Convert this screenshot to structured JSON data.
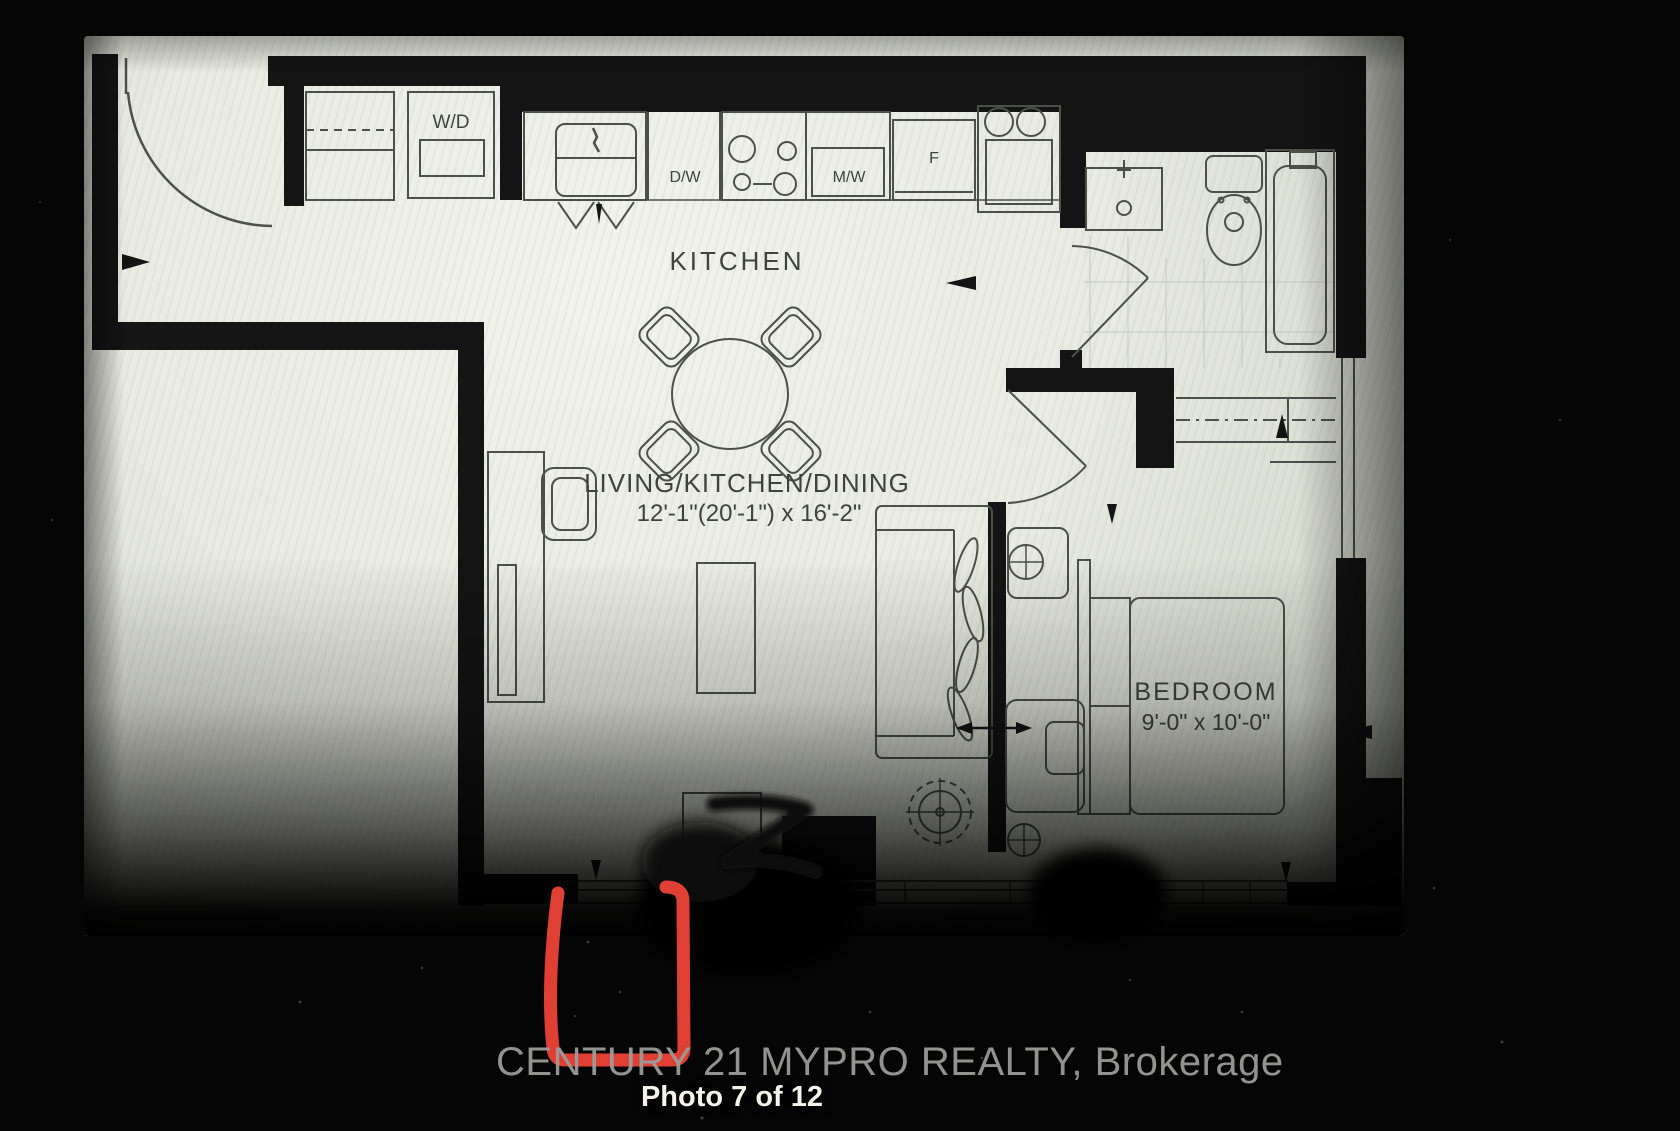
{
  "photo": {
    "watermark": "CENTURY 21 MYPRO REALTY, Brokerage",
    "caption": "Photo 7 of 12"
  },
  "floor_plan": {
    "rooms": [
      {
        "label": "KITCHEN",
        "dimensions": ""
      },
      {
        "label": "LIVING/KITCHEN/DINING",
        "dimensions": "12'-1\"(20'-1\") x 16'-2\""
      },
      {
        "label": "BEDROOM",
        "dimensions": "9'-0\" x 10'-0\""
      }
    ],
    "appliance_labels": {
      "washer_dryer": "W/D",
      "dishwasher": "D/W",
      "microwave": "M/W",
      "fridge": "F"
    },
    "colors": {
      "annotation_red": "#ee4437",
      "walls": "#141414",
      "paper": "#e9ebe2",
      "plan_lines": "#4b5149"
    }
  }
}
